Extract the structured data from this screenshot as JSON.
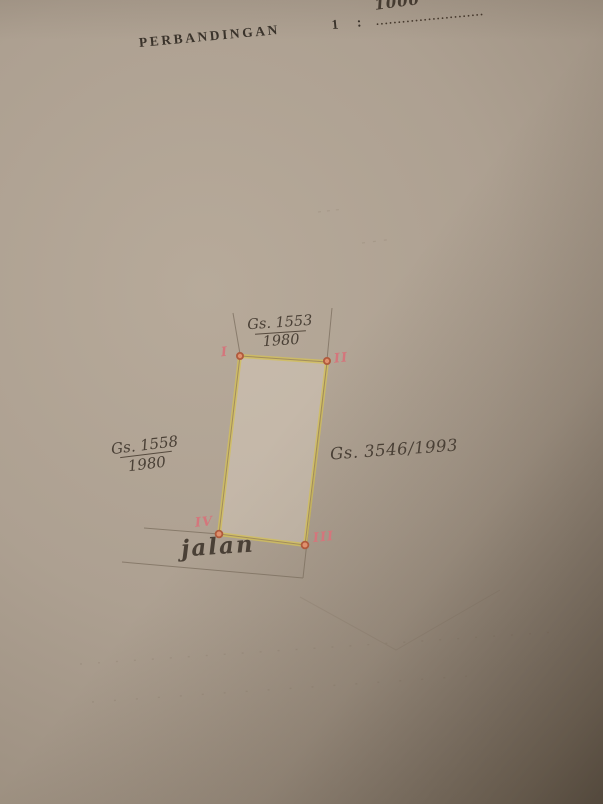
{
  "header": {
    "label": "PERBANDINGAN",
    "one": "1",
    "colon": ":",
    "scale_value": "1000",
    "dots": "........................."
  },
  "diagram": {
    "parcel_top": {
      "number": "Gs. 1553",
      "year": "1980"
    },
    "parcel_left": {
      "number": "Gs. 1558",
      "year": "1980"
    },
    "parcel_right": {
      "number": "Gs. 3546/1993"
    },
    "road_label": "jalan",
    "corner_labels": {
      "top_left": "I",
      "top_right": "II",
      "bottom_right": "III",
      "bottom_left": "IV"
    }
  },
  "colors": {
    "paper_light": "#b7aa9a",
    "paper_shadow_corner": "#55493e",
    "plot_highlight_yellow": "#d2bf5a",
    "survey_line_brown": "#7e7161",
    "handwriting_ink": "#4a4036",
    "printed_ink": "#3a332b",
    "corner_dot_red": "#b05a3c",
    "corner_numeral_pink": "#d4767c"
  }
}
